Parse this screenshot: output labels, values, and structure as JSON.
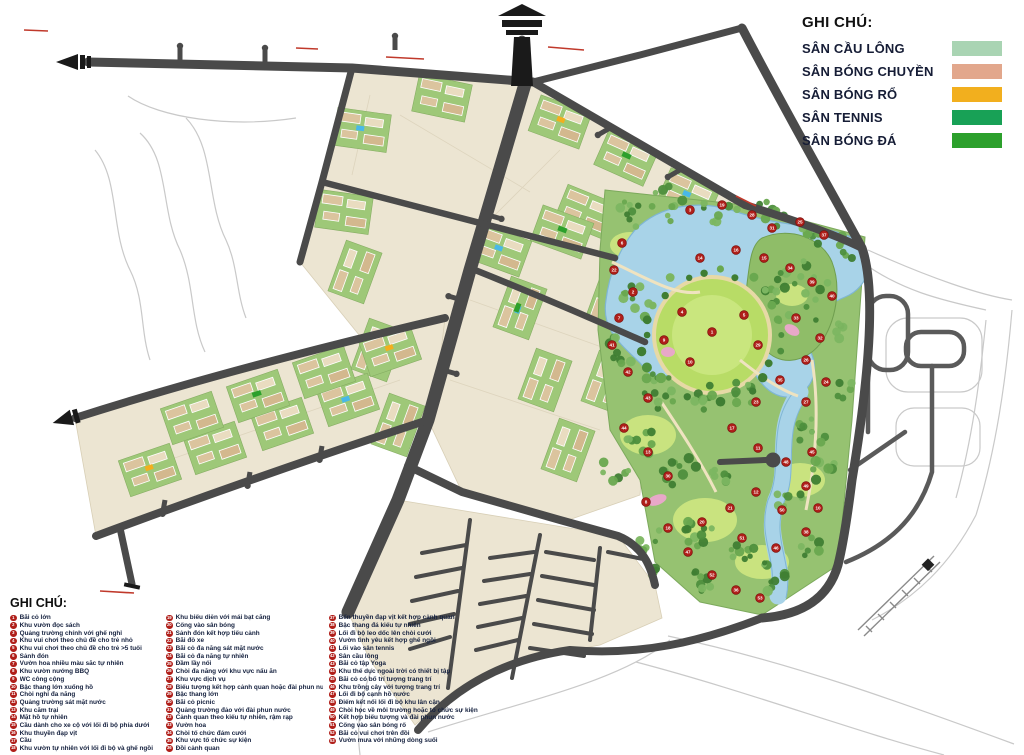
{
  "legend_sports": {
    "title": "GHI CHÚ:",
    "items": [
      {
        "label": "SÂN CẦU LÔNG",
        "color": "#a9d4b3"
      },
      {
        "label": "SÂN BÓNG CHUYỀN",
        "color": "#e2a78c"
      },
      {
        "label": "SÂN BÓNG RỔ",
        "color": "#f2af1e"
      },
      {
        "label": "SÂN TENNIS",
        "color": "#18a156"
      },
      {
        "label": "SÂN BÓNG ĐÁ",
        "color": "#2ca02c"
      }
    ]
  },
  "legend_notes": {
    "title": "GHI CHÚ:",
    "columns": [
      {
        "items": [
          {
            "n": 1,
            "label": "Bãi cỏ lớn"
          },
          {
            "n": 2,
            "label": "Khu vườn đọc sách"
          },
          {
            "n": 3,
            "label": "Quảng trường chính với ghế nghỉ"
          },
          {
            "n": 4,
            "label": "Khu vui chơi theo chủ đề cho trẻ nhỏ"
          },
          {
            "n": 5,
            "label": "Khu vui chơi theo chủ đề cho trẻ >5 tuổi"
          },
          {
            "n": 6,
            "label": "Sảnh đón"
          },
          {
            "n": 7,
            "label": "Vườn hoa nhiều màu sắc tự nhiên"
          },
          {
            "n": 8,
            "label": "Khu vườn nướng BBQ"
          },
          {
            "n": 9,
            "label": "WC công cộng"
          },
          {
            "n": 10,
            "label": "Bậc thang lớn xuống hồ"
          },
          {
            "n": 11,
            "label": "Chòi nghỉ đa năng"
          },
          {
            "n": 12,
            "label": "Quảng trường sát mặt nước"
          },
          {
            "n": 13,
            "label": "Khu cắm trại"
          },
          {
            "n": 14,
            "label": "Mặt hồ tự nhiên"
          },
          {
            "n": 15,
            "label": "Cầu dành cho xe cộ với lối đi bộ phía dưới"
          },
          {
            "n": 16,
            "label": "Khu thuyền đạp vịt"
          },
          {
            "n": 17,
            "label": "Cầu"
          },
          {
            "n": 18,
            "label": "Khu vườn tự nhiên với lối đi bộ và ghế ngồi"
          }
        ]
      },
      {
        "items": [
          {
            "n": 19,
            "label": "Khu biểu diễn với mái bạt căng"
          },
          {
            "n": 20,
            "label": "Cổng vào sân bóng"
          },
          {
            "n": 21,
            "label": "Sảnh đón kết hợp tiểu cảnh"
          },
          {
            "n": 22,
            "label": "Bãi đỗ xe"
          },
          {
            "n": 23,
            "label": "Bãi cỏ đa năng sát mặt nước"
          },
          {
            "n": 24,
            "label": "Bãi cỏ đa năng tự nhiên"
          },
          {
            "n": 25,
            "label": "Đầm lầy nổi"
          },
          {
            "n": 26,
            "label": "Chòi đa năng với khu vực nấu ăn"
          },
          {
            "n": 27,
            "label": "Khu vực dịch vụ"
          },
          {
            "n": 28,
            "label": "Biểu tượng kết hợp cảnh quan hoặc đài phun nước"
          },
          {
            "n": 29,
            "label": "Bậc thang lớn"
          },
          {
            "n": 30,
            "label": "Bãi cỏ picnic"
          },
          {
            "n": 31,
            "label": "Quảng trường đảo với đài phun nước"
          },
          {
            "n": 32,
            "label": "Cảnh quan theo kiểu tự nhiên, rậm rạp"
          },
          {
            "n": 33,
            "label": "Vườn hoa"
          },
          {
            "n": 34,
            "label": "Chòi tổ chức đám cưới"
          },
          {
            "n": 35,
            "label": "Khu vực tổ chức sự kiện"
          },
          {
            "n": 36,
            "label": "Đồi cảnh quan"
          }
        ]
      },
      {
        "items": [
          {
            "n": 37,
            "label": "Bến thuyền đạp vịt kết hợp cảnh quan"
          },
          {
            "n": 38,
            "label": "Bậc thang đá kiểu tự nhiên"
          },
          {
            "n": 39,
            "label": "Lối đi bộ leo dốc lên chòi cưới"
          },
          {
            "n": 40,
            "label": "Vườn tình yêu kết hợp ghế ngồi"
          },
          {
            "n": 41,
            "label": "Lối vào sân tennis"
          },
          {
            "n": 42,
            "label": "Sân cầu lông"
          },
          {
            "n": 43,
            "label": "Bãi cỏ tập Yoga"
          },
          {
            "n": 44,
            "label": "Khu thể dục ngoài trời có thiết bị tập"
          },
          {
            "n": 45,
            "label": "Bãi cỏ có bố trí tượng trang trí"
          },
          {
            "n": 46,
            "label": "Khu trồng cây với tượng trang trí"
          },
          {
            "n": 47,
            "label": "Lối đi bộ cạnh hồ nước"
          },
          {
            "n": 48,
            "label": "Điểm kết nối lối đi bộ khu lân cận"
          },
          {
            "n": 49,
            "label": "Chòi học về môi trường hoặc tổ chức sự kiện"
          },
          {
            "n": 50,
            "label": "Kết hợp biểu tượng và đài phun nước"
          },
          {
            "n": 51,
            "label": "Cổng vào sân bóng rổ"
          },
          {
            "n": 52,
            "label": "Bãi cỏ vui chơi trên đồi"
          },
          {
            "n": 53,
            "label": "Vườn mưa với những dòng suối"
          }
        ]
      }
    ]
  },
  "map_markers": [
    {
      "n": 6,
      "x": 622,
      "y": 243
    },
    {
      "n": 22,
      "x": 614,
      "y": 270
    },
    {
      "n": 2,
      "x": 633,
      "y": 292
    },
    {
      "n": 7,
      "x": 619,
      "y": 318
    },
    {
      "n": 41,
      "x": 612,
      "y": 345
    },
    {
      "n": 42,
      "x": 628,
      "y": 372
    },
    {
      "n": 43,
      "x": 648,
      "y": 398
    },
    {
      "n": 44,
      "x": 624,
      "y": 428
    },
    {
      "n": 13,
      "x": 648,
      "y": 452
    },
    {
      "n": 30,
      "x": 668,
      "y": 476
    },
    {
      "n": 8,
      "x": 646,
      "y": 502
    },
    {
      "n": 18,
      "x": 668,
      "y": 528
    },
    {
      "n": 47,
      "x": 688,
      "y": 552
    },
    {
      "n": 52,
      "x": 712,
      "y": 575
    },
    {
      "n": 36,
      "x": 736,
      "y": 590
    },
    {
      "n": 53,
      "x": 760,
      "y": 598
    },
    {
      "n": 3,
      "x": 690,
      "y": 210
    },
    {
      "n": 19,
      "x": 722,
      "y": 205
    },
    {
      "n": 28,
      "x": 752,
      "y": 215
    },
    {
      "n": 31,
      "x": 772,
      "y": 228
    },
    {
      "n": 25,
      "x": 800,
      "y": 222
    },
    {
      "n": 37,
      "x": 824,
      "y": 235
    },
    {
      "n": 14,
      "x": 700,
      "y": 258
    },
    {
      "n": 16,
      "x": 736,
      "y": 250
    },
    {
      "n": 15,
      "x": 764,
      "y": 258
    },
    {
      "n": 34,
      "x": 790,
      "y": 268
    },
    {
      "n": 39,
      "x": 812,
      "y": 282
    },
    {
      "n": 40,
      "x": 832,
      "y": 296
    },
    {
      "n": 1,
      "x": 712,
      "y": 332
    },
    {
      "n": 4,
      "x": 682,
      "y": 312
    },
    {
      "n": 5,
      "x": 744,
      "y": 315
    },
    {
      "n": 29,
      "x": 758,
      "y": 345
    },
    {
      "n": 10,
      "x": 690,
      "y": 362
    },
    {
      "n": 9,
      "x": 664,
      "y": 340
    },
    {
      "n": 33,
      "x": 796,
      "y": 318
    },
    {
      "n": 32,
      "x": 820,
      "y": 338
    },
    {
      "n": 26,
      "x": 806,
      "y": 360
    },
    {
      "n": 35,
      "x": 780,
      "y": 380
    },
    {
      "n": 23,
      "x": 756,
      "y": 402
    },
    {
      "n": 27,
      "x": 806,
      "y": 402
    },
    {
      "n": 24,
      "x": 826,
      "y": 382
    },
    {
      "n": 17,
      "x": 732,
      "y": 428
    },
    {
      "n": 11,
      "x": 758,
      "y": 448
    },
    {
      "n": 48,
      "x": 786,
      "y": 462
    },
    {
      "n": 45,
      "x": 812,
      "y": 452
    },
    {
      "n": 49,
      "x": 806,
      "y": 486
    },
    {
      "n": 12,
      "x": 756,
      "y": 492
    },
    {
      "n": 50,
      "x": 782,
      "y": 510
    },
    {
      "n": 21,
      "x": 730,
      "y": 508
    },
    {
      "n": 38,
      "x": 806,
      "y": 532
    },
    {
      "n": 46,
      "x": 776,
      "y": 548
    },
    {
      "n": 51,
      "x": 742,
      "y": 538
    },
    {
      "n": 20,
      "x": 702,
      "y": 522
    },
    {
      "n": 10,
      "x": 818,
      "y": 508
    }
  ],
  "colors": {
    "road": "#4a4a4a",
    "block": "#ece5d2",
    "building": "#dbc49e",
    "courtyard": "#9ec878",
    "park": "#96c271",
    "lawn": "#c9e37f",
    "water": "#a8d3e8",
    "marker": "#b01f1a",
    "future_outline": "#c9c9c9"
  }
}
